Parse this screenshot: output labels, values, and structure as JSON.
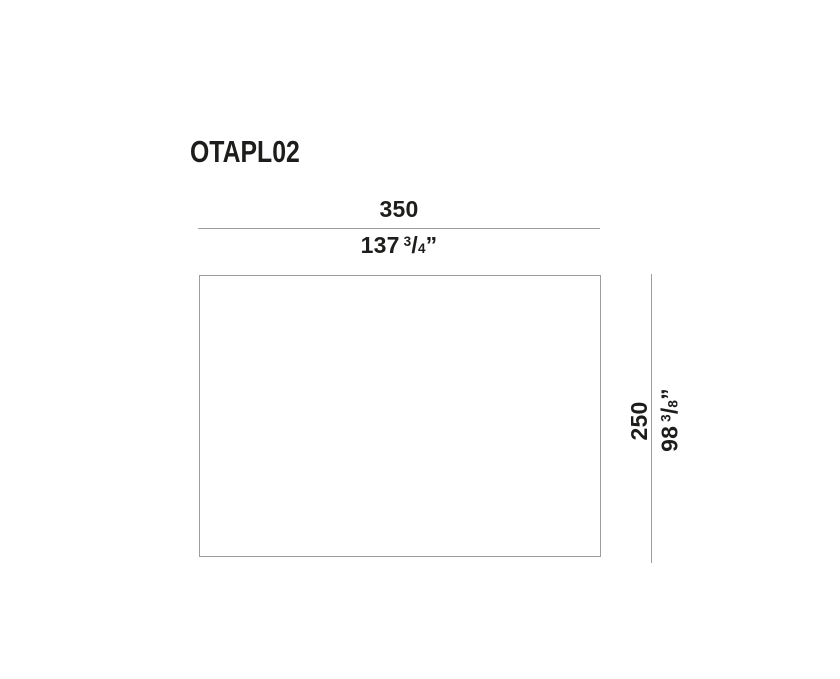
{
  "drawing": {
    "title": "OTAPL02",
    "width_dimension": {
      "metric_value": "350",
      "imperial_whole": "137",
      "imperial_numerator": "3",
      "imperial_slash": "/",
      "imperial_denominator": "4",
      "imperial_unit": "”"
    },
    "height_dimension": {
      "metric_value": "250",
      "imperial_whole": "98",
      "imperial_numerator": "3",
      "imperial_slash": "/",
      "imperial_denominator": "8",
      "imperial_unit": "”"
    },
    "colors": {
      "line": "#9d9d9d",
      "text": "#1d1d1b",
      "background": "#ffffff"
    }
  }
}
